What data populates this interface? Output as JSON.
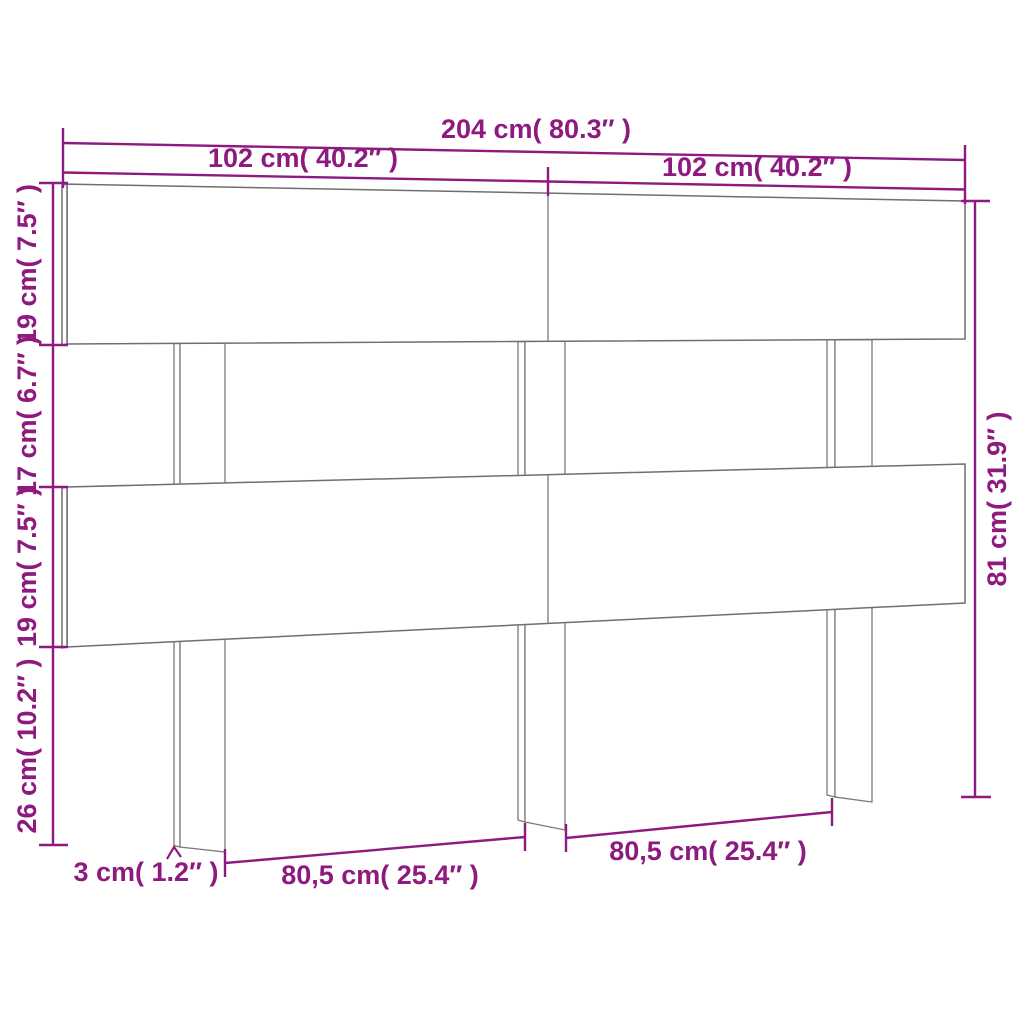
{
  "diagram": {
    "title": "headboard dimension drawing",
    "colors": {
      "dimension_accent": "#8E1A80",
      "outline_gray": "#6F6F6F",
      "background": "#FFFFFF"
    },
    "dims": {
      "total_width": "204 cm( 80.3″ )",
      "left_half_width": "102 cm( 40.2″ )",
      "right_half_width": "102 cm( 40.2″ )",
      "top_slat_height": "19 cm( 7.5″ )",
      "slat_gap_height": "17 cm( 6.7″ )",
      "middle_slat_height": "19 cm( 7.5″ )",
      "legs_below_height": "26 cm( 10.2″ )",
      "total_height": "81 cm( 31.9″ )",
      "leg_thickness": "3 cm( 1.2″ )",
      "left_leg_spacing": "80,5 cm( 25.4″ )",
      "right_leg_spacing": "80,5 cm( 25.4″ )"
    }
  }
}
